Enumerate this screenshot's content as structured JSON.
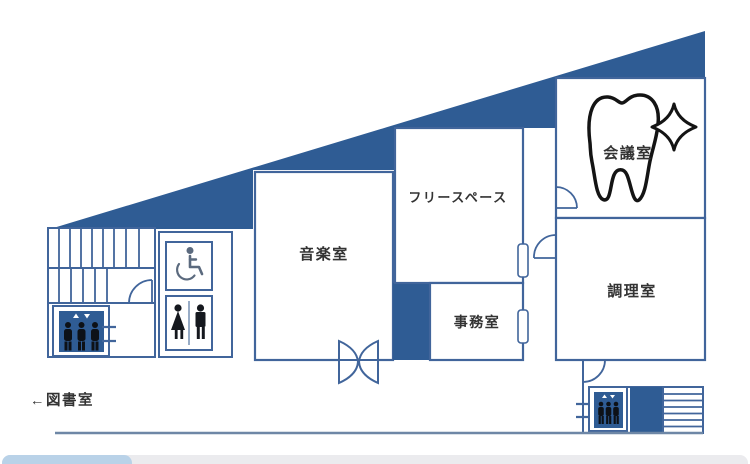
{
  "plan_title": "facility-floor-plan",
  "rooms": {
    "meeting": "会議室",
    "free_space": "フリースペース",
    "music": "音楽室",
    "office": "事務室",
    "cooking": "調理室"
  },
  "labels": {
    "library_direction": "←図書室"
  },
  "icons": {
    "tooth": "tooth-icon",
    "sparkle": "sparkle-icon",
    "elevator_left": "elevator-icon",
    "elevator_right": "elevator-icon",
    "wheelchair": "wheelchair-accessible-icon",
    "restroom": "restroom-man-woman-icon",
    "stairs_left": "stairs",
    "stairs_right": "stairs",
    "double_swing_door": "double-swing-door-icon",
    "door_arcs": "door-swing-icon",
    "window_ticks": "window-mark"
  },
  "colors": {
    "roof_fill": "#2F5C94",
    "wall_stroke": "#41659B",
    "label_text": "#333333",
    "black_outline": "#141414",
    "pictogram_dark": "#15181E",
    "wheelchair_gray": "#5B6A7E",
    "south_wall": "#6E87A6",
    "scrollbar_track": "#EBEBEE",
    "scrollbar_thumb": "#B9D2E8"
  }
}
